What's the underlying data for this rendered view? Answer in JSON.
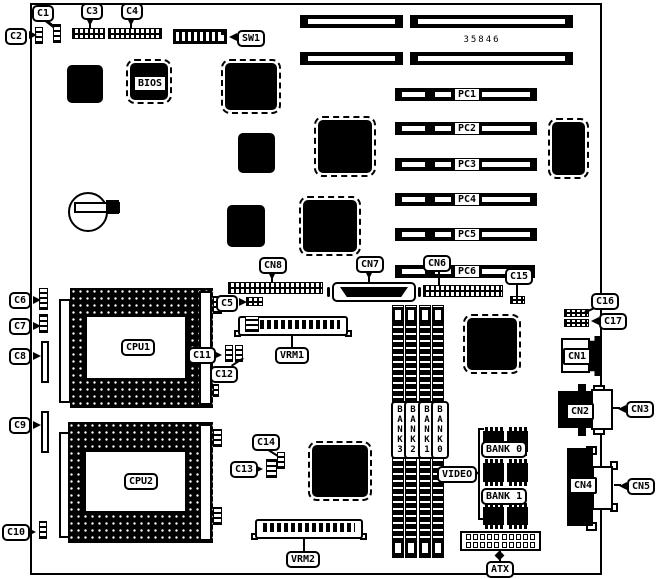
{
  "diagram": {
    "part_number": "35846",
    "callouts": {
      "c1": "C1",
      "c2": "C2",
      "c3": "C3",
      "c4": "C4",
      "c5": "C5",
      "c6": "C6",
      "c7": "C7",
      "c8": "C8",
      "c9": "C9",
      "c10": "C10",
      "c11": "C11",
      "c12": "C12",
      "c13": "C13",
      "c14": "C14",
      "c15": "C15",
      "c16": "C16",
      "c17": "C17",
      "cn1": "CN1",
      "cn2": "CN2",
      "cn3": "CN3",
      "cn4": "CN4",
      "cn5": "CN5",
      "cn6": "CN6",
      "cn7": "CN7",
      "cn8": "CN8",
      "sw1": "SW1",
      "bios": "BIOS",
      "atx": "ATX",
      "video": "VIDEO",
      "cpu1": "CPU1",
      "cpu2": "CPU2",
      "vrm1": "VRM1",
      "vrm2": "VRM2"
    },
    "pci_slots": {
      "pc1": "PC1",
      "pc2": "PC2",
      "pc3": "PC3",
      "pc4": "PC4",
      "pc5": "PC5",
      "pc6": "PC6"
    },
    "memory_banks": {
      "bank3": "BANK3",
      "bank2": "BANK2",
      "bank1": "BANK1",
      "bank0": "BANK0"
    },
    "video_memory_banks": {
      "bank0": "BANK 0",
      "bank1": "BANK 1"
    },
    "colors": {
      "ink": "#000000",
      "paper": "#ffffff"
    }
  }
}
